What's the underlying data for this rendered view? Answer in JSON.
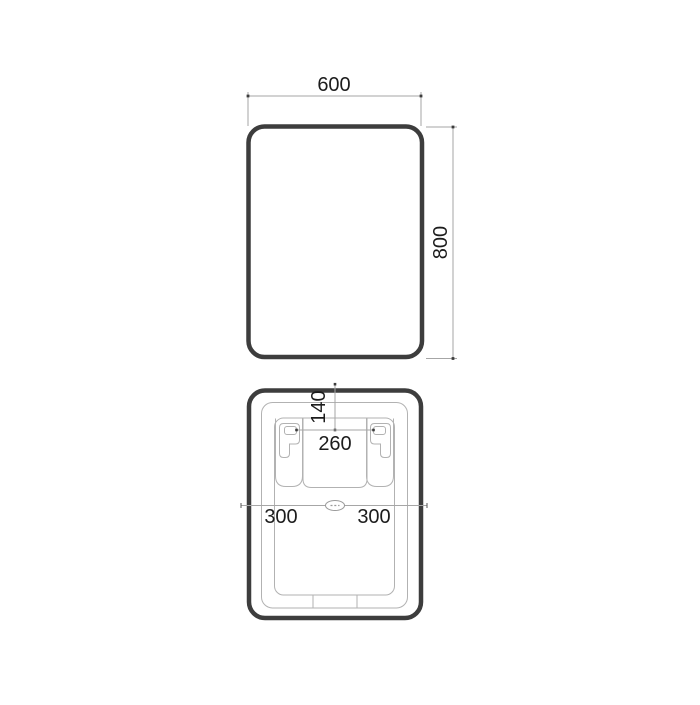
{
  "drawing": {
    "type": "technical-dimension-drawing",
    "front_view": {
      "width_label": "600",
      "height_label": "800"
    },
    "rear_view": {
      "top_offset_label": "140",
      "bracket_spacing_label": "260",
      "left_center_label": "300",
      "right_center_label": "300"
    }
  },
  "colors": {
    "background": "#ffffff",
    "heavy_outline": "#3d3d3d",
    "thin_line": "#b2b2b2",
    "dimension_line": "#a6a6a6",
    "text": "#1c1c1c"
  }
}
